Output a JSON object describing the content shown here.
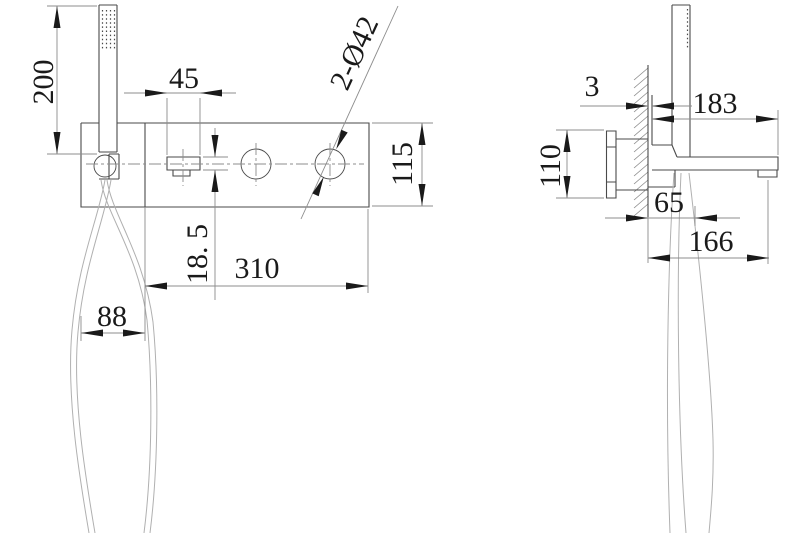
{
  "drawing_type": "faucet-installation-dimension-drawing",
  "colors": {
    "background": "#ffffff",
    "geometry": "#4a4a4a",
    "dimension": "#8c8c8c",
    "hose": "#b0b0b0",
    "ink": "#1a1a1a"
  },
  "front_view": {
    "handshower_height": "200",
    "handle_width": "45",
    "handle_holes": "2-Ø42",
    "panel_height": "115",
    "handle_depth": "18. 5",
    "panel_width": "310",
    "hose_bay_width": "88"
  },
  "side_view": {
    "wall_plate_thickness": "3",
    "overall_depth": "183",
    "inwall_body_height": "110",
    "holder_depth": "65",
    "spout_outlet_depth": "166"
  }
}
